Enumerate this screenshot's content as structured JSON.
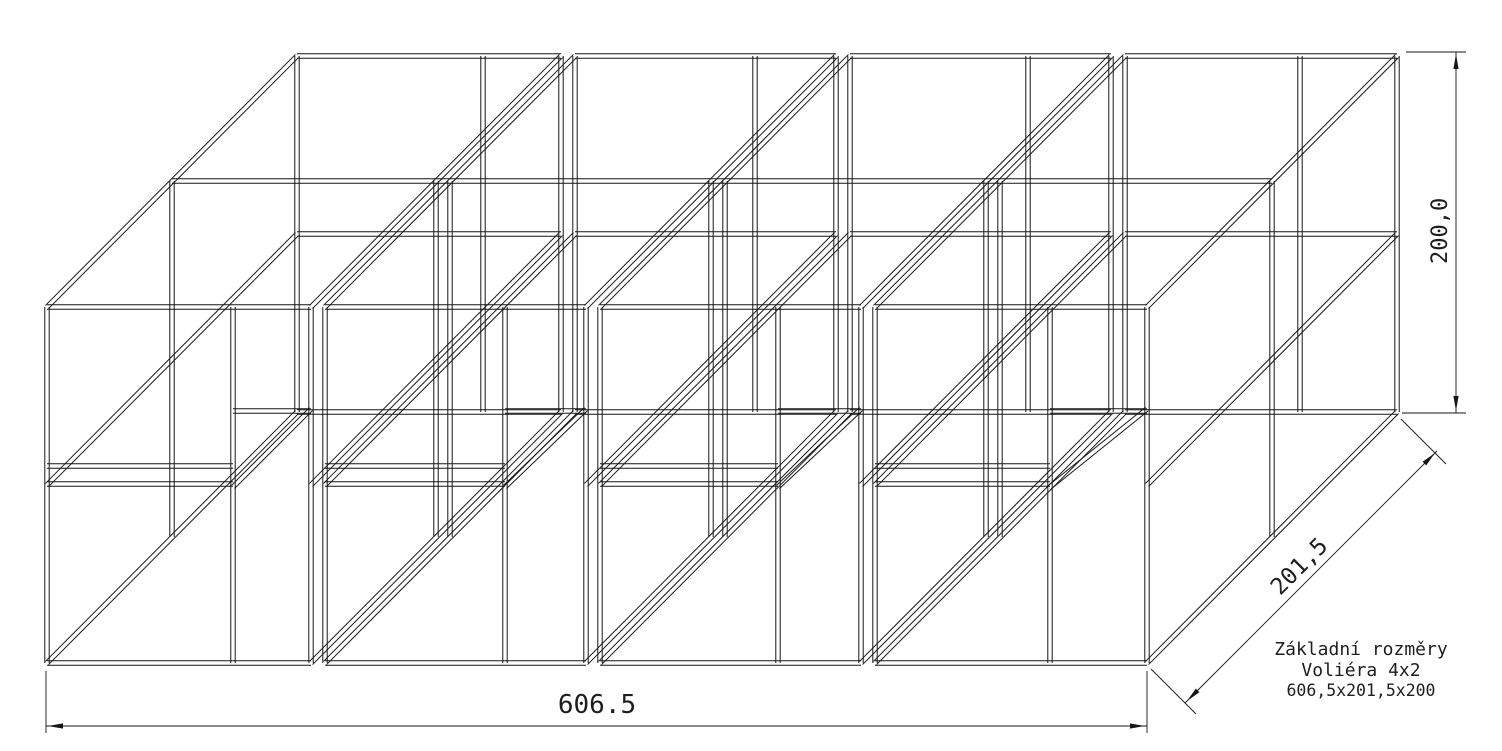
{
  "drawing": {
    "background": "#ffffff",
    "line_color": "#161616",
    "dimensions": {
      "width": "606.5",
      "depth": "201,5",
      "height": "200,0"
    },
    "title_block": {
      "line1": "Základní rozměry",
      "line2": "Voliéra 4x2",
      "line3": "606,5x201,5x200"
    }
  }
}
